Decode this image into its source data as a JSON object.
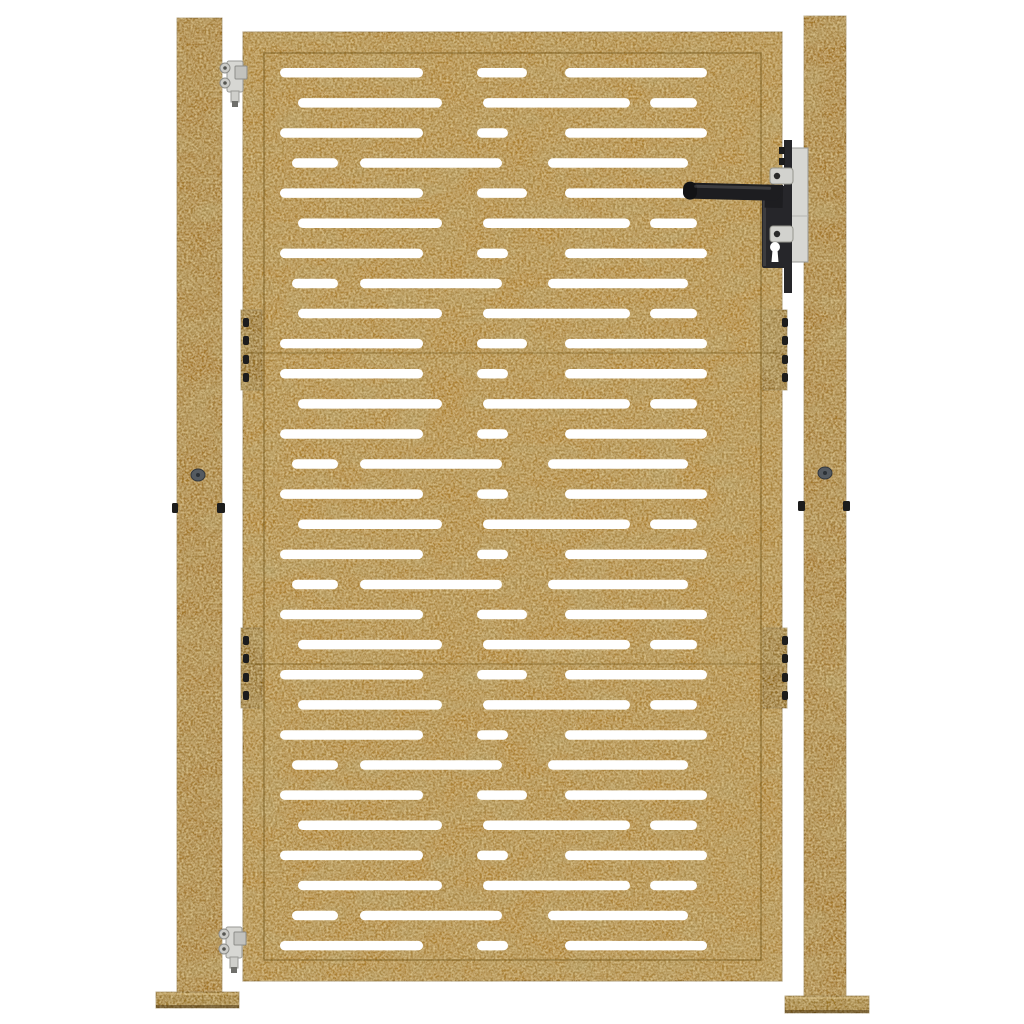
{
  "scene": {
    "title": "Product photo: corten steel garden gate with horizontal slot cut-out pattern, two square posts, black lever lock and silver hinges on white background",
    "background": "#ffffff",
    "width": 1024,
    "height": 1024
  },
  "palette": {
    "rust_post": "#a1762b",
    "rust_gate": "#ab8033",
    "rust_plate": "#8e681d",
    "rust_base_plate": "#96701f",
    "rust_edge_line": "#6f5318",
    "slot_white": "#ffffff",
    "handle_black": "#1d1d20",
    "lock_black": "#26262a",
    "silver": "#d7d7d3",
    "silver_dark": "#9a9a96",
    "bolt_gray": "#545a60",
    "nub_black": "#1c1c1c"
  },
  "left_post": {
    "x": 177,
    "y": 18,
    "w": 45,
    "h": 982,
    "base_plate": {
      "x": 156,
      "y": 992,
      "w": 83,
      "h": 16
    },
    "bolt": {
      "cx": 198,
      "cy": 475,
      "rx": 7,
      "ry": 6
    },
    "side_nubs": [
      {
        "x": 172,
        "y": 503,
        "w": 6,
        "h": 10
      },
      {
        "x": 217,
        "y": 503,
        "w": 8,
        "h": 10
      }
    ]
  },
  "right_post": {
    "x": 804,
    "y": 16,
    "w": 42,
    "h": 992,
    "base_plate": {
      "x": 785,
      "y": 996,
      "w": 84,
      "h": 17
    },
    "bolt": {
      "cx": 825,
      "cy": 473,
      "rx": 7,
      "ry": 6
    },
    "side_nubs": [
      {
        "x": 798,
        "y": 501,
        "w": 7,
        "h": 10
      },
      {
        "x": 843,
        "y": 501,
        "w": 7,
        "h": 10
      }
    ]
  },
  "gate": {
    "x": 243,
    "y": 32,
    "w": 539,
    "h": 949,
    "inner_inset": 21,
    "seams_y": [
      353,
      664
    ],
    "slot_height": 9.5,
    "slot_radius": 4.75,
    "row_start_y": 68,
    "row_pitch": 30.1,
    "row_types": {
      "A": [
        [
          280,
          423
        ],
        [
          477,
          527
        ],
        [
          565,
          707
        ]
      ],
      "B": [
        [
          298,
          442
        ],
        [
          483,
          630
        ],
        [
          650,
          697
        ]
      ],
      "C": [
        [
          280,
          423
        ],
        [
          477,
          508
        ],
        [
          565,
          707
        ]
      ],
      "D": [
        [
          292,
          338
        ],
        [
          360,
          502
        ],
        [
          548,
          688
        ]
      ]
    },
    "row_sequence": [
      "A",
      "B",
      "C",
      "D",
      "A",
      "B",
      "C",
      "D",
      "B",
      "A",
      "C",
      "B",
      "C",
      "D",
      "C",
      "B",
      "C",
      "D",
      "A",
      "B",
      "A",
      "B",
      "C",
      "D",
      "A",
      "B",
      "C",
      "B",
      "D",
      "C"
    ],
    "hinge_plates": [
      {
        "x": 241,
        "y": 310,
        "w": 21,
        "h": 80,
        "dots_x": 243,
        "dots_y": [
          318,
          336,
          355,
          373
        ]
      },
      {
        "x": 241,
        "y": 628,
        "w": 21,
        "h": 80,
        "dots_x": 243,
        "dots_y": [
          636,
          654,
          673,
          691
        ]
      },
      {
        "x": 763,
        "y": 310,
        "w": 24,
        "h": 80,
        "dots_x": 782,
        "dots_y": [
          318,
          336,
          355,
          373
        ]
      },
      {
        "x": 763,
        "y": 628,
        "w": 24,
        "h": 80,
        "dots_x": 782,
        "dots_y": [
          636,
          654,
          673,
          691
        ]
      }
    ]
  },
  "lock": {
    "strike_plate": {
      "x": 787,
      "y": 148,
      "w": 21,
      "h": 114
    },
    "bar": {
      "x": 784,
      "y": 140,
      "w": 8,
      "h": 153
    },
    "body": {
      "x": 762,
      "y": 186,
      "w": 30,
      "h": 82
    },
    "lever": {
      "x1": 686,
      "x2": 781,
      "y": 185,
      "h": 16,
      "tilt_deg": 1.5
    },
    "screw_tabs": [
      {
        "x": 770,
        "y": 168,
        "w": 23,
        "h": 16,
        "dot_cx": 777,
        "dot_cy": 176
      },
      {
        "x": 770,
        "y": 226,
        "w": 23,
        "h": 16,
        "dot_cx": 777,
        "dot_cy": 234
      }
    ],
    "keyhole": {
      "cx": 775,
      "cy": 247,
      "r": 5,
      "tail_bottom": 262
    },
    "top_nubs": [
      {
        "x": 779,
        "y": 147,
        "w": 6,
        "h": 7
      },
      {
        "x": 779,
        "y": 158,
        "w": 6,
        "h": 7
      }
    ]
  },
  "hinges": [
    {
      "x": 218,
      "y": 60
    },
    {
      "x": 217,
      "y": 926
    }
  ]
}
